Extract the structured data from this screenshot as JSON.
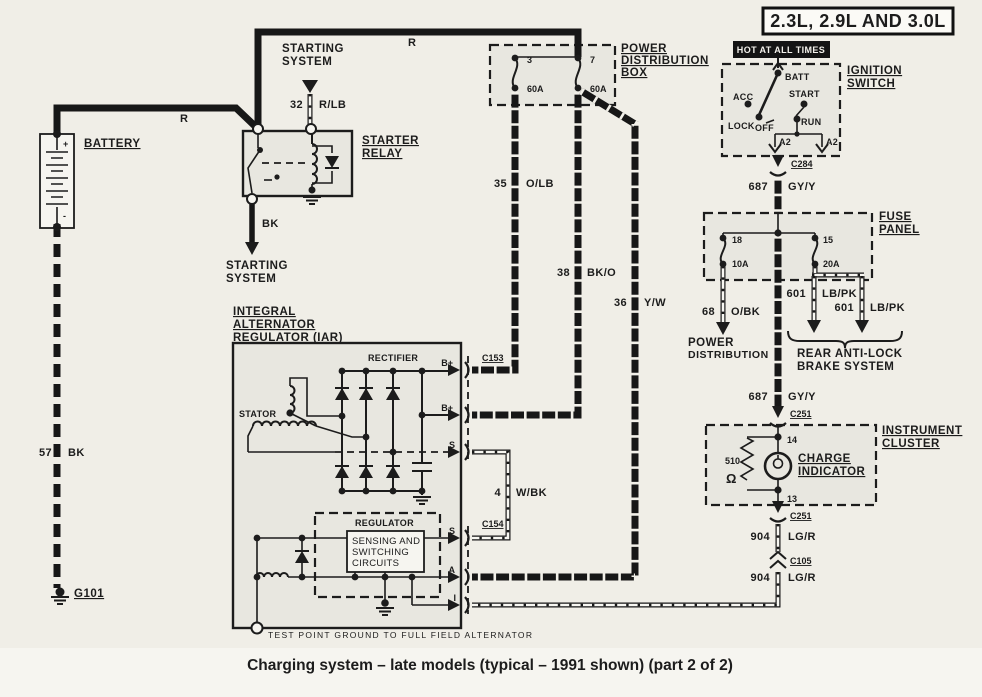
{
  "header": {
    "title_box": "2.3L, 2.9L AND 3.0L",
    "hot_banner": "HOT AT ALL TIMES"
  },
  "caption": "Charging system – late models (typical – 1991 shown) (part 2 of 2)",
  "battery": {
    "label": "BATTERY",
    "plus": "+",
    "minus": "-",
    "g101": "G101",
    "wire57": {
      "circuit": "57",
      "color": "BK"
    }
  },
  "starting_top": {
    "line1": "STARTING",
    "line2": "SYSTEM"
  },
  "starting_bottom": {
    "line1": "STARTING",
    "line2": "SYSTEM"
  },
  "relay": {
    "line1": "STARTER",
    "line2": "RELAY"
  },
  "power_box": {
    "l1": "POWER",
    "l2": "DISTRIBUTION",
    "l3": "BOX",
    "f3": {
      "id": "3",
      "rating": "60A"
    },
    "f7": {
      "id": "7",
      "rating": "60A"
    }
  },
  "ignition": {
    "l1": "IGNITION",
    "l2": "SWITCH",
    "batt": "BATT",
    "acc": "ACC",
    "start": "START",
    "lock": "LOCK",
    "off": "OFF",
    "run": "RUN",
    "a2l": "A2",
    "a2r": "A2",
    "c284": "C284"
  },
  "fuse_panel": {
    "l1": "FUSE",
    "l2": "PANEL",
    "f18": {
      "id": "18",
      "rating": "10A"
    },
    "f15": {
      "id": "15",
      "rating": "20A"
    }
  },
  "dest_power": {
    "l1": "POWER",
    "l2": "DISTRIBUTION"
  },
  "dest_rabs": {
    "l1": "REAR ANTI-LOCK",
    "l2": "BRAKE SYSTEM"
  },
  "cluster": {
    "l1": "INSTRUMENT",
    "l2": "CLUSTER",
    "c251_top": "C251",
    "c251_bot": "C251",
    "c105": "C105",
    "pin14": "14",
    "pin13": "13",
    "r_value": "510",
    "r_unit": "Ω",
    "ind1": "CHARGE",
    "ind2": "INDICATOR"
  },
  "iar": {
    "l1": "INTEGRAL",
    "l2": "ALTERNATOR",
    "l3": "REGULATOR (IAR)",
    "rectifier": "RECTIFIER",
    "stator": "STATOR",
    "reg": "REGULATOR",
    "sense1": "SENSING AND",
    "sense2": "SWITCHING",
    "sense3": "CIRCUITS",
    "c153": "C153",
    "c154": "C154",
    "b1": "B+",
    "b2": "B+",
    "s1": "S",
    "s2": "S",
    "a": "A",
    "i": "I",
    "note": "TEST POINT GROUND TO FULL FIELD ALTERNATOR"
  },
  "wires": {
    "r_battery": "R",
    "r_feed": "R",
    "bk": "BK",
    "w32": {
      "circuit": "32",
      "color": "R/LB"
    },
    "w35": {
      "circuit": "35",
      "color": "O/LB"
    },
    "w38": {
      "circuit": "38",
      "color": "BK/O"
    },
    "w36": {
      "circuit": "36",
      "color": "Y/W"
    },
    "w687a": {
      "circuit": "687",
      "color": "GY/Y"
    },
    "w687b": {
      "circuit": "687",
      "color": "GY/Y"
    },
    "w68": {
      "circuit": "68",
      "color": "O/BK"
    },
    "w601a": {
      "circuit": "601",
      "color": "LB/PK"
    },
    "w601b": {
      "circuit": "601",
      "color": "LB/PK"
    },
    "w904a": {
      "circuit": "904",
      "color": "LG/R"
    },
    "w904b": {
      "circuit": "904",
      "color": "LG/R"
    },
    "w4": {
      "circuit": "4",
      "color": "W/BK"
    }
  }
}
